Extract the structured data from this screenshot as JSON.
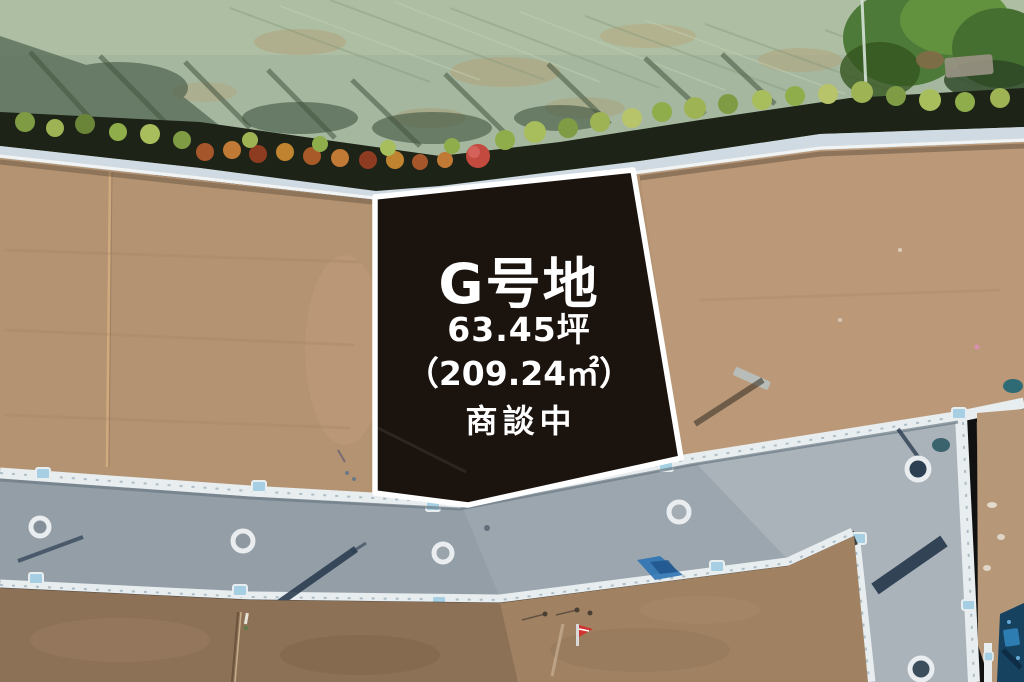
{
  "overlay": {
    "lot_name": "G号地",
    "area_tsubo": "63.45坪",
    "area_m2": "（209.24㎡）",
    "status": "商談中"
  },
  "colors": {
    "panel": "#1b130e",
    "panel_border": "#ffffff",
    "panel_text": "#ffffff",
    "field_green": "#a5b89f",
    "hedge_dark": "#1d2316",
    "dirt_upper": "#b39372",
    "dirt_lower": "#8d7157",
    "road_asphalt": "#939ea7",
    "curb_white": "#e8edef",
    "gutter_blue": "#a6cfe3"
  }
}
